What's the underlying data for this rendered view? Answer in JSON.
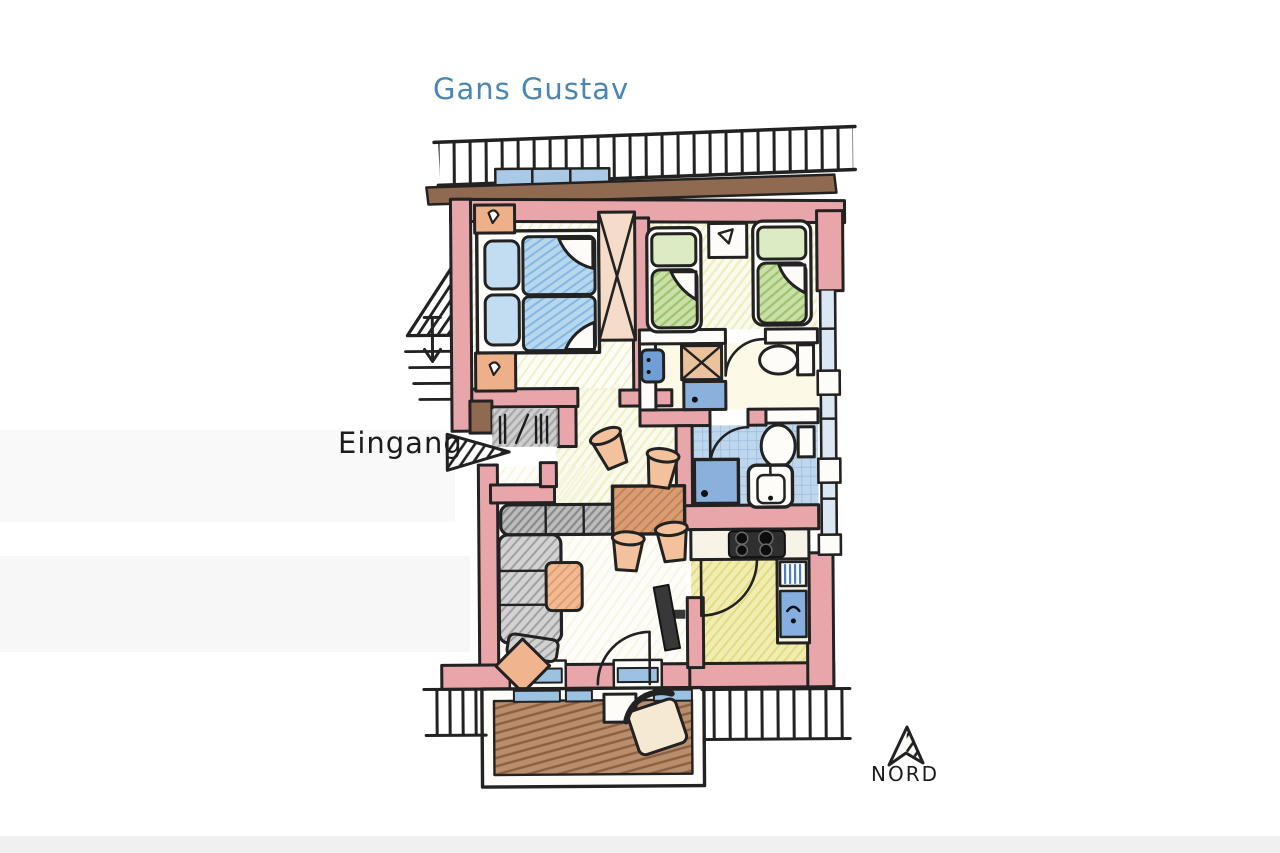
{
  "labels": {
    "plan_title": "Gans Gustav",
    "entrance": "Eingang",
    "compass": "NORD"
  },
  "colors": {
    "title_text": "#4a86b4",
    "label_text": "#1c1c1c",
    "outline": "#222222",
    "wall_pink": "#e9a6aa",
    "wall_brown": "#8f6a50",
    "window_blue": "#9cc2e2",
    "bed_blue": "#b5d8ef",
    "bed_green": "#cae0a6",
    "floor_yellow_green": "#dcdc82",
    "bath_tile_blue": "#b7d2ea",
    "shower_blue": "#89b1dc",
    "kitchen_yellow": "#eeea9c",
    "balcony_wood_brown": "#b98e6d",
    "sofa_grey": "#d2d2d2",
    "furniture_orange": "#f0b58e",
    "table_brown": "#d89d72",
    "stove_black": "#2f2f2f"
  },
  "icons": {
    "entrance_arrow": "hatched-arrow-right",
    "compass_arrow": "hand-drawn-arrow-up",
    "stairs": "hatched-stairs",
    "wardrobe": "x-crossed-box",
    "washing_machine": "x-crossed-box"
  }
}
